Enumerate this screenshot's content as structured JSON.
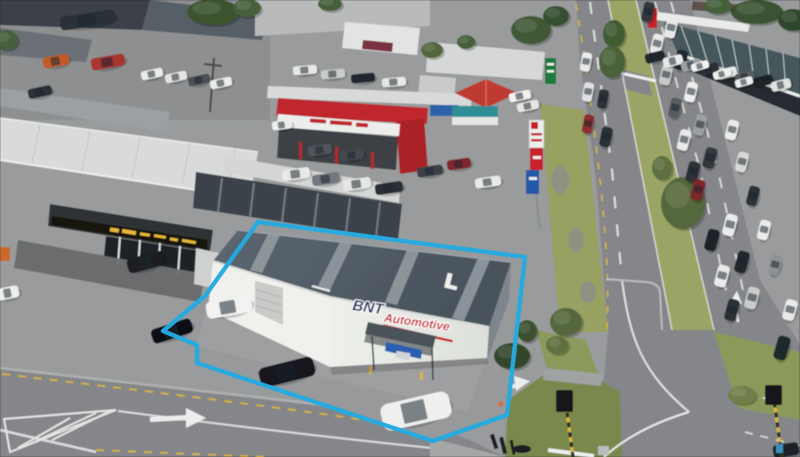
{
  "scene": {
    "description": "Aerial drone view of a commercial automotive property highlighted with a blue boundary outline"
  },
  "outline": {
    "color": "#25aae1",
    "points": "258,222 525,257 507,415 433,441 197,363 197,345 163,331 205,296"
  },
  "signs": {
    "bnt": {
      "brand": "BNT",
      "word": "Automotive",
      "brand_color": "#1d2d5c",
      "word_color": "#c8242c"
    }
  },
  "palette": {
    "asphalt": "#86888a",
    "footpath": "#999b9c",
    "property_pavement": "#97999b",
    "building_wall": "#eceee9",
    "building_roof": "#515c66",
    "roof_stripe": "#939ba1",
    "grass_median": "#9aa565",
    "grass_verge": "#82924f",
    "tree": "#3f5a33",
    "red_building": "#c0282e",
    "yellow_line": "#d8b435",
    "outline_blue": "#25aae1"
  },
  "cars": [
    {
      "x": 229,
      "y": 307,
      "w": 46,
      "h": 17,
      "a": -10,
      "c": "#f2f3f1"
    },
    {
      "x": 287,
      "y": 372,
      "w": 56,
      "h": 20,
      "a": -14,
      "c": "#14171c"
    },
    {
      "x": 416,
      "y": 411,
      "w": 70,
      "h": 27,
      "a": -13,
      "c": "#eef0ee"
    },
    {
      "x": 172,
      "y": 331,
      "w": 42,
      "h": 15,
      "a": -18,
      "c": "#0f1114"
    },
    {
      "x": 146,
      "y": 262,
      "w": 38,
      "h": 15,
      "a": -15,
      "c": "#1a1d21"
    },
    {
      "x": 8,
      "y": 293,
      "w": 22,
      "h": 12,
      "a": -12,
      "c": "#eef0ee"
    },
    {
      "x": 296,
      "y": 174,
      "w": 28,
      "h": 11,
      "a": -8,
      "c": "#e8e9e7"
    },
    {
      "x": 326,
      "y": 179,
      "w": 28,
      "h": 11,
      "a": -8,
      "c": "#74797e"
    },
    {
      "x": 357,
      "y": 184,
      "w": 28,
      "h": 11,
      "a": -8,
      "c": "#e6e7e5"
    },
    {
      "x": 389,
      "y": 188,
      "w": 28,
      "h": 11,
      "a": -8,
      "c": "#2b2f34"
    },
    {
      "x": 430,
      "y": 171,
      "w": 26,
      "h": 10,
      "a": -8,
      "c": "#3c4147"
    },
    {
      "x": 459,
      "y": 164,
      "w": 24,
      "h": 10,
      "a": -8,
      "c": "#7e262b"
    },
    {
      "x": 488,
      "y": 182,
      "w": 26,
      "h": 10,
      "a": -8,
      "c": "#e9eae8"
    },
    {
      "x": 282,
      "y": 125,
      "w": 20,
      "h": 9,
      "a": -8,
      "c": "#edeeec"
    },
    {
      "x": 320,
      "y": 150,
      "w": 24,
      "h": 10,
      "a": -8,
      "c": "#51565c"
    },
    {
      "x": 352,
      "y": 155,
      "w": 24,
      "h": 10,
      "a": -8,
      "c": "#454a50"
    },
    {
      "x": 305,
      "y": 70,
      "w": 24,
      "h": 9,
      "a": -5,
      "c": "#e7e8e6"
    },
    {
      "x": 333,
      "y": 74,
      "w": 24,
      "h": 9,
      "a": -5,
      "c": "#caccca"
    },
    {
      "x": 363,
      "y": 78,
      "w": 24,
      "h": 9,
      "a": -5,
      "c": "#24282d"
    },
    {
      "x": 394,
      "y": 82,
      "w": 24,
      "h": 9,
      "a": -5,
      "c": "#e7e8e6"
    },
    {
      "x": 520,
      "y": 96,
      "w": 22,
      "h": 9,
      "a": -12,
      "c": "#f0f1ef"
    },
    {
      "x": 528,
      "y": 106,
      "w": 22,
      "h": 9,
      "a": -12,
      "c": "#e6e7e5"
    },
    {
      "x": 152,
      "y": 74,
      "w": 22,
      "h": 9,
      "a": -12,
      "c": "#ebecea"
    },
    {
      "x": 176,
      "y": 77,
      "w": 22,
      "h": 9,
      "a": -12,
      "c": "#e3e4e2"
    },
    {
      "x": 199,
      "y": 80,
      "w": 22,
      "h": 9,
      "a": -12,
      "c": "#4b4f54"
    },
    {
      "x": 221,
      "y": 83,
      "w": 22,
      "h": 9,
      "a": -12,
      "c": "#ebecea"
    },
    {
      "x": 108,
      "y": 62,
      "w": 34,
      "h": 12,
      "a": -10,
      "c": "#a8342e"
    },
    {
      "x": 56,
      "y": 61,
      "w": 26,
      "h": 11,
      "a": -10,
      "c": "#c05a28"
    },
    {
      "x": 88,
      "y": 20,
      "w": 56,
      "h": 14,
      "a": -8,
      "c": "#2c3138"
    },
    {
      "x": 40,
      "y": 92,
      "w": 24,
      "h": 10,
      "a": -12,
      "c": "#2c3036"
    },
    {
      "x": 586,
      "y": 62,
      "w": 10,
      "h": 19,
      "a": 10,
      "c": "#e9eaeb"
    },
    {
      "x": 588,
      "y": 92,
      "w": 10,
      "h": 19,
      "a": 10,
      "c": "#dfe0e1"
    },
    {
      "x": 603,
      "y": 99,
      "w": 10,
      "h": 19,
      "a": 10,
      "c": "#2e3338"
    },
    {
      "x": 588,
      "y": 124,
      "w": 10,
      "h": 19,
      "a": 11,
      "c": "#8c2f30"
    },
    {
      "x": 606,
      "y": 137,
      "w": 11,
      "h": 20,
      "a": 12,
      "c": "#2b3036"
    },
    {
      "x": 648,
      "y": 12,
      "w": 11,
      "h": 20,
      "a": 13,
      "c": "#33383d"
    },
    {
      "x": 657,
      "y": 44,
      "w": 11,
      "h": 20,
      "a": 13,
      "c": "#e8e9e8"
    },
    {
      "x": 666,
      "y": 75,
      "w": 11,
      "h": 20,
      "a": 13,
      "c": "#c9cbca"
    },
    {
      "x": 675,
      "y": 108,
      "w": 11,
      "h": 20,
      "a": 13,
      "c": "#565b60"
    },
    {
      "x": 684,
      "y": 140,
      "w": 11,
      "h": 21,
      "a": 14,
      "c": "#e8e9e8"
    },
    {
      "x": 693,
      "y": 172,
      "w": 12,
      "h": 21,
      "a": 14,
      "c": "#2e3338"
    },
    {
      "x": 698,
      "y": 190,
      "w": 12,
      "h": 21,
      "a": 14,
      "c": "#7e262b"
    },
    {
      "x": 712,
      "y": 240,
      "w": 12,
      "h": 22,
      "a": 15,
      "c": "#1f2327"
    },
    {
      "x": 722,
      "y": 276,
      "w": 12,
      "h": 22,
      "a": 15,
      "c": "#e9eae9"
    },
    {
      "x": 732,
      "y": 310,
      "w": 12,
      "h": 22,
      "a": 15,
      "c": "#2b3035"
    },
    {
      "x": 671,
      "y": 28,
      "w": 11,
      "h": 20,
      "a": 13,
      "c": "#e8e9e8"
    },
    {
      "x": 681,
      "y": 60,
      "w": 11,
      "h": 20,
      "a": 13,
      "c": "#24282d"
    },
    {
      "x": 691,
      "y": 92,
      "w": 11,
      "h": 20,
      "a": 13,
      "c": "#eceded"
    },
    {
      "x": 700,
      "y": 125,
      "w": 11,
      "h": 21,
      "a": 14,
      "c": "#9b9fa2"
    },
    {
      "x": 710,
      "y": 158,
      "w": 12,
      "h": 21,
      "a": 14,
      "c": "#33383d"
    },
    {
      "x": 730,
      "y": 225,
      "w": 12,
      "h": 22,
      "a": 15,
      "c": "#e9eae9"
    },
    {
      "x": 742,
      "y": 262,
      "w": 12,
      "h": 22,
      "a": 15,
      "c": "#24282c"
    },
    {
      "x": 752,
      "y": 298,
      "w": 12,
      "h": 22,
      "a": 15,
      "c": "#caccca"
    },
    {
      "x": 782,
      "y": 348,
      "w": 13,
      "h": 24,
      "a": 16,
      "c": "#1d2a2b"
    },
    {
      "x": 732,
      "y": 130,
      "w": 11,
      "h": 20,
      "a": 14,
      "c": "#ecedeb"
    },
    {
      "x": 742,
      "y": 162,
      "w": 11,
      "h": 20,
      "a": 14,
      "c": "#d8d9d7"
    },
    {
      "x": 753,
      "y": 196,
      "w": 11,
      "h": 20,
      "a": 14,
      "c": "#2e3338"
    },
    {
      "x": 764,
      "y": 230,
      "w": 11,
      "h": 20,
      "a": 14,
      "c": "#ecedeb"
    },
    {
      "x": 775,
      "y": 265,
      "w": 11,
      "h": 20,
      "a": 15,
      "c": "#8e9295"
    },
    {
      "x": 790,
      "y": 310,
      "w": 12,
      "h": 21,
      "a": 15,
      "c": "#e9eae9"
    },
    {
      "x": 655,
      "y": 57,
      "w": 20,
      "h": 10,
      "a": -14,
      "c": "#23272c"
    },
    {
      "x": 673,
      "y": 61,
      "w": 20,
      "h": 10,
      "a": -14,
      "c": "#e8eae9"
    },
    {
      "x": 691,
      "y": 65,
      "w": 20,
      "h": 10,
      "a": -14,
      "c": "#9ca0a3"
    },
    {
      "x": 709,
      "y": 69,
      "w": 20,
      "h": 10,
      "a": -14,
      "c": "#2e3338"
    },
    {
      "x": 727,
      "y": 73,
      "w": 20,
      "h": 10,
      "a": -14,
      "c": "#e8eae9"
    },
    {
      "x": 745,
      "y": 77,
      "w": 20,
      "h": 10,
      "a": -14,
      "c": "#565b61"
    },
    {
      "x": 763,
      "y": 81,
      "w": 20,
      "h": 10,
      "a": -14,
      "c": "#1e2227"
    },
    {
      "x": 781,
      "y": 85,
      "w": 20,
      "h": 10,
      "a": -14,
      "c": "#dfe1e0"
    },
    {
      "x": 700,
      "y": 66,
      "w": 18,
      "h": 8,
      "a": -16,
      "c": "#f1f2f0"
    },
    {
      "x": 722,
      "y": 74,
      "w": 18,
      "h": 8,
      "a": -16,
      "c": "#f1f2f0"
    },
    {
      "x": 744,
      "y": 82,
      "w": 18,
      "h": 8,
      "a": -16,
      "c": "#eceded"
    },
    {
      "x": 786,
      "y": 450,
      "w": 26,
      "h": 13,
      "a": -8,
      "c": "#1e2226"
    }
  ],
  "bushes": [
    {
      "x": 614,
      "y": 34,
      "rx": 11,
      "ry": 14,
      "c": "#3f5a33"
    },
    {
      "x": 612,
      "y": 62,
      "rx": 13,
      "ry": 16,
      "c": "#486238"
    },
    {
      "x": 683,
      "y": 203,
      "rx": 22,
      "ry": 26,
      "c": "#55683c"
    },
    {
      "x": 662,
      "y": 168,
      "rx": 10,
      "ry": 12,
      "c": "#5d7040"
    },
    {
      "x": 213,
      "y": 12,
      "rx": 26,
      "ry": 13,
      "c": "#3c532f"
    },
    {
      "x": 247,
      "y": 8,
      "rx": 14,
      "ry": 9,
      "c": "#46603b"
    },
    {
      "x": 531,
      "y": 30,
      "rx": 20,
      "ry": 14,
      "c": "#3f5834"
    },
    {
      "x": 556,
      "y": 16,
      "rx": 13,
      "ry": 10,
      "c": "#365030"
    },
    {
      "x": 757,
      "y": 12,
      "rx": 26,
      "ry": 12,
      "c": "#3b5230"
    },
    {
      "x": 793,
      "y": 20,
      "rx": 15,
      "ry": 11,
      "c": "#2f4729"
    },
    {
      "x": 718,
      "y": 6,
      "rx": 14,
      "ry": 8,
      "c": "#44603a"
    },
    {
      "x": 512,
      "y": 356,
      "rx": 18,
      "ry": 13,
      "c": "#31462c"
    },
    {
      "x": 527,
      "y": 331,
      "rx": 10,
      "ry": 11,
      "c": "#3a512f"
    },
    {
      "x": 566,
      "y": 322,
      "rx": 16,
      "ry": 14,
      "c": "#55683c"
    },
    {
      "x": 6,
      "y": 40,
      "rx": 12,
      "ry": 10,
      "c": "#44603a"
    },
    {
      "x": 330,
      "y": 4,
      "rx": 12,
      "ry": 7,
      "c": "#46603b"
    },
    {
      "x": 432,
      "y": 50,
      "rx": 11,
      "ry": 8,
      "c": "#52663c"
    },
    {
      "x": 466,
      "y": 42,
      "rx": 9,
      "ry": 7,
      "c": "#46603b"
    },
    {
      "x": 742,
      "y": 395,
      "rx": 14,
      "ry": 9,
      "c": "#6f7f48"
    },
    {
      "x": 557,
      "y": 345,
      "rx": 11,
      "ry": 9,
      "c": "#60713f"
    }
  ]
}
